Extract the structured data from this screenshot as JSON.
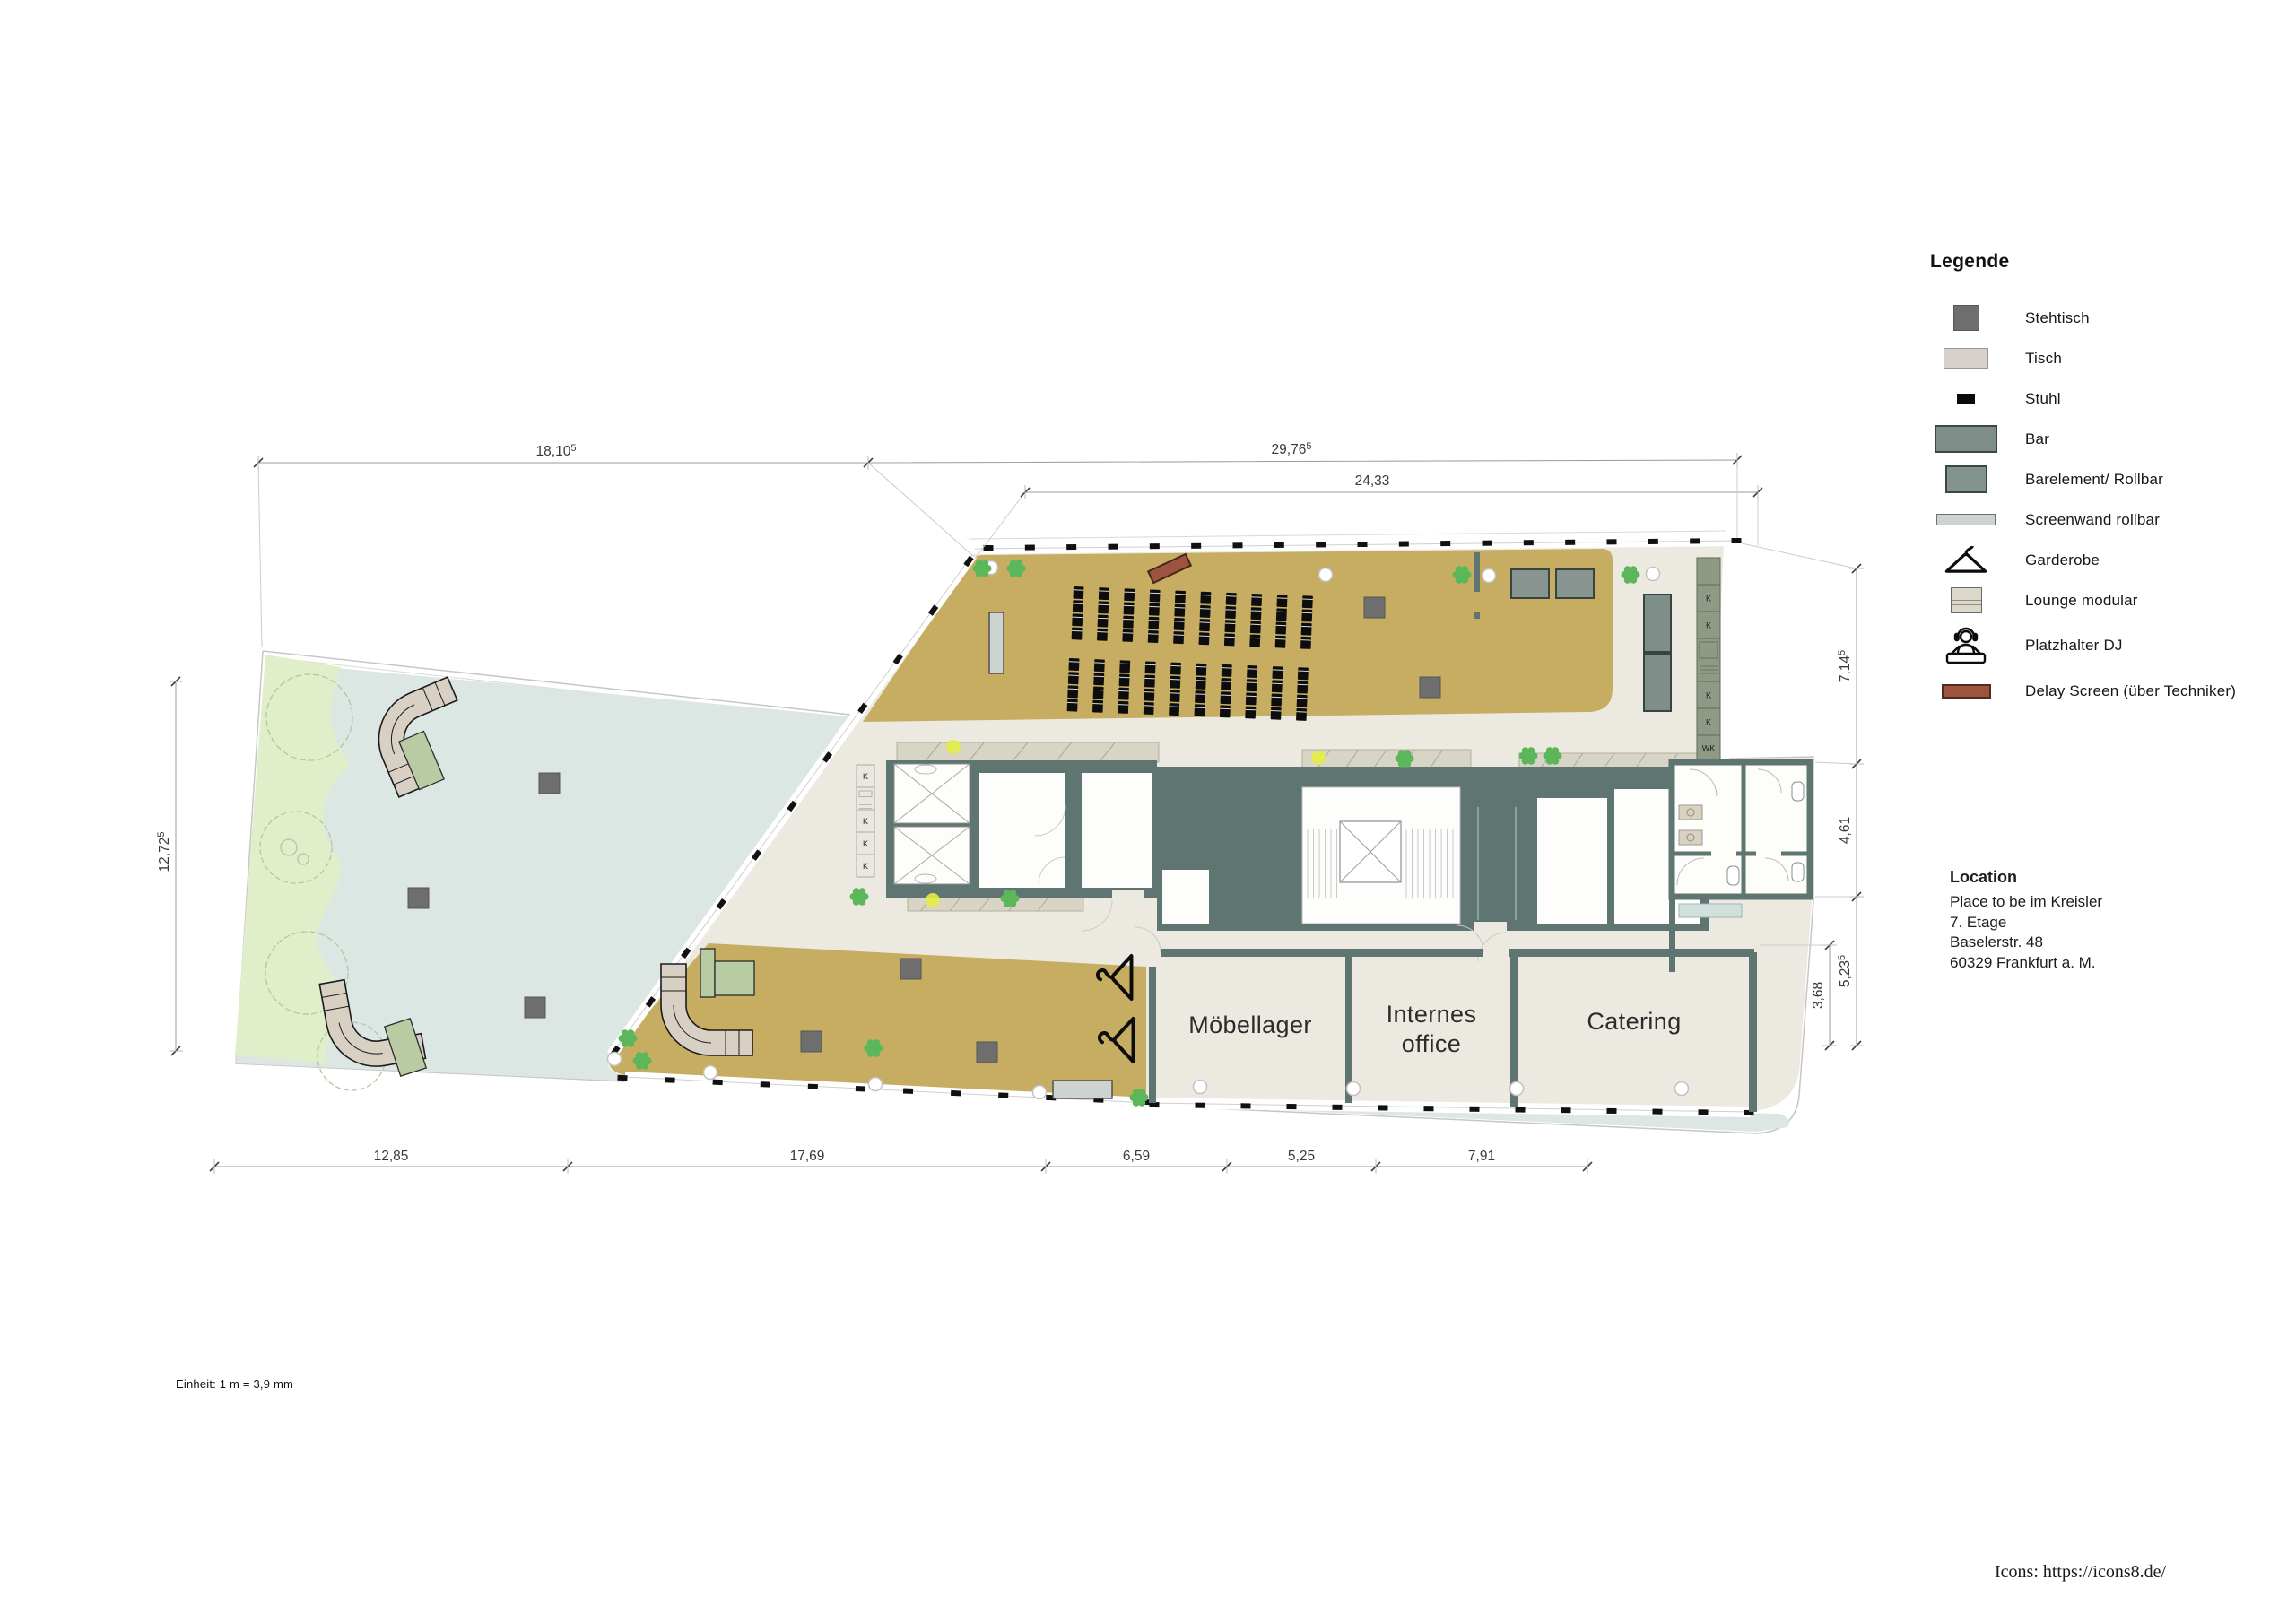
{
  "legend": {
    "title": "Legende",
    "items": [
      {
        "label": "Stehtisch"
      },
      {
        "label": "Tisch"
      },
      {
        "label": "Stuhl"
      },
      {
        "label": "Bar"
      },
      {
        "label": "Barelement/ Rollbar"
      },
      {
        "label": "Screenwand rollbar"
      },
      {
        "label": "Garderobe"
      },
      {
        "label": "Lounge modular"
      },
      {
        "label": "Platzhalter DJ"
      },
      {
        "label": "Delay Screen (über Techniker)"
      }
    ]
  },
  "location": {
    "title": "Location",
    "line1": "Place to be im Kreisler",
    "line2": "7. Etage",
    "line3": "Baselerstr. 48",
    "line4": "60329 Frankfurt a. M."
  },
  "rooms": {
    "moebellager": "Möbellager",
    "internes_line1": "Internes",
    "internes_line2": "office",
    "catering": "Catering"
  },
  "dimensions": {
    "top": [
      {
        "main": "18,10",
        "sup": "5"
      },
      {
        "main": "29,76",
        "sup": "5"
      },
      {
        "main": "24,33",
        "sup": ""
      }
    ],
    "bottom": [
      {
        "main": "12,85",
        "sup": ""
      },
      {
        "main": "17,69",
        "sup": ""
      },
      {
        "main": "6,59",
        "sup": ""
      },
      {
        "main": "5,25",
        "sup": ""
      },
      {
        "main": "7,91",
        "sup": ""
      }
    ],
    "left": [
      {
        "main": "12,72",
        "sup": "5"
      }
    ],
    "right": [
      {
        "main": "7,14",
        "sup": "5"
      },
      {
        "main": "4,61",
        "sup": ""
      },
      {
        "main": "5,23",
        "sup": "5"
      },
      {
        "main": "3,68",
        "sup": ""
      }
    ]
  },
  "closets": {
    "right": [
      "K",
      "K",
      "K",
      "K",
      "WK"
    ],
    "left": [
      "K",
      "K",
      "K",
      "K"
    ]
  },
  "seating": {
    "blocks": 2,
    "rows": 4,
    "cols": 10
  },
  "notes": {
    "scale_note": "Einheit: 1 m = 3,9 mm",
    "credits": "Icons: https://icons8.de/"
  },
  "colors": {
    "floor_event": "#c6ad62",
    "terrace": "#dce6e2",
    "greenery": "#e0efca",
    "interior": "#ece9e0",
    "walls": "#5e7572",
    "bar": "#7e8f8a",
    "barelement": "#87948f",
    "screen": "#ccd3d0",
    "delay_screen": "#9c5440",
    "chair": "#0d0d0d",
    "plant": "#5cb65a",
    "lounge": "#d8d0c3",
    "lounge_table": "#b9cba3"
  }
}
